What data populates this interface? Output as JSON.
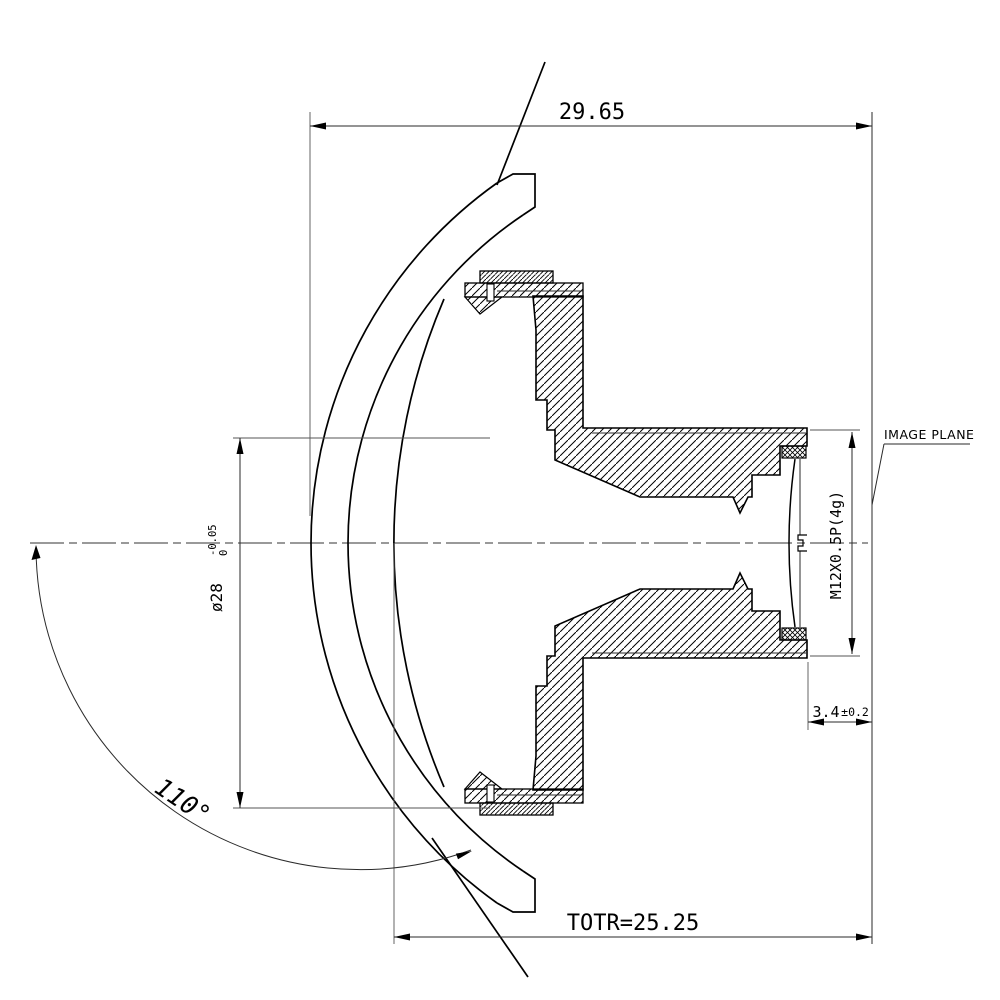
{
  "drawing": {
    "colors": {
      "line": "#000000",
      "background": "#ffffff"
    },
    "dims": {
      "total_length": "29.65",
      "totr": "TOTR=25.25",
      "back_focus": "3.4",
      "back_focus_tol": "±0.2",
      "outer_diameter": "ø28",
      "outer_diameter_tol_upper": "0",
      "outer_diameter_tol_lower": "-0.05",
      "thread_spec": "M12X0.5P(4g)",
      "field_of_view": "110°"
    },
    "labels": {
      "image_plane": "IMAGE PLANE"
    }
  }
}
